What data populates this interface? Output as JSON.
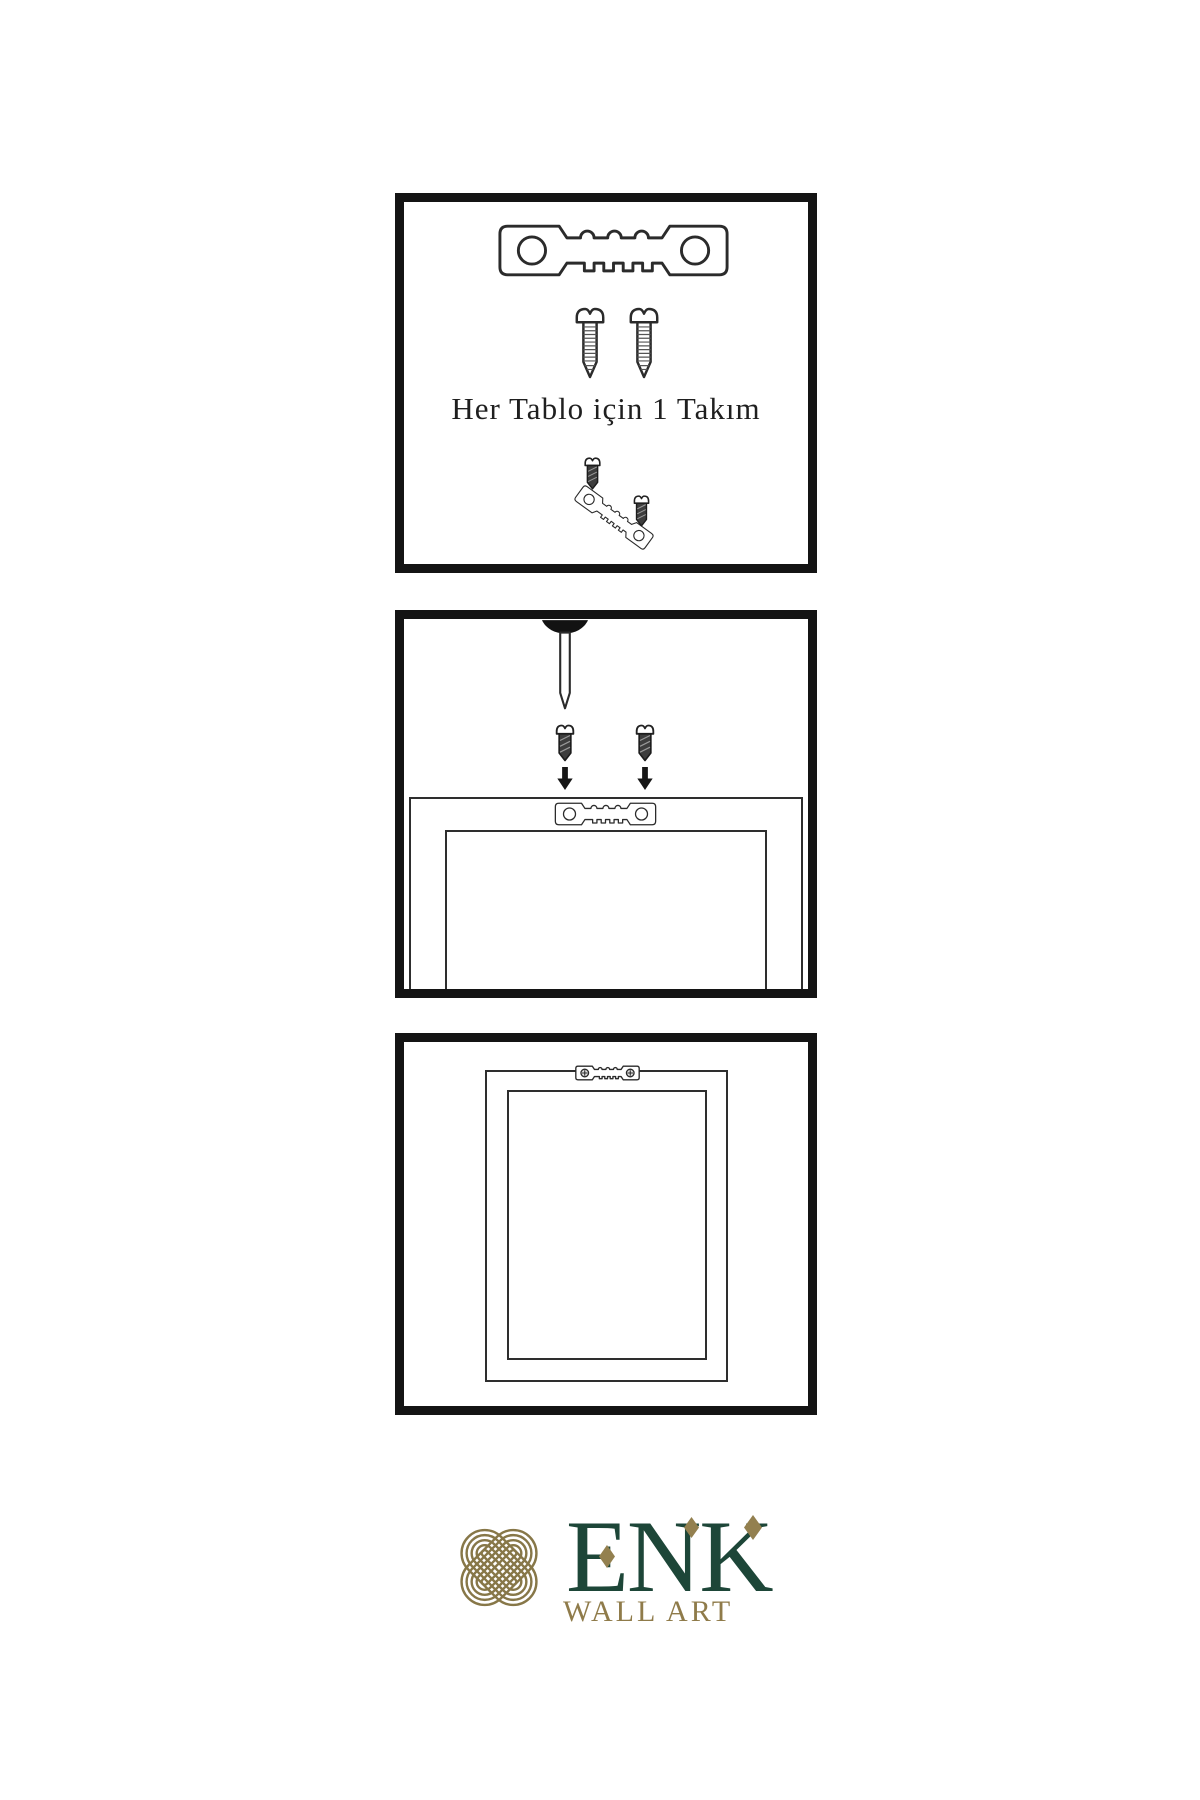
{
  "document": {
    "type": "wall-art-hanging-instructions",
    "background": "#ffffff"
  },
  "panel1": {
    "title": "hardware-kit-contents",
    "caption": "Her Tablo için 1 Takım",
    "items": [
      "sawtooth-hanger",
      "screw",
      "screw",
      "screw-driven-into-hanger-demo"
    ]
  },
  "panel2": {
    "title": "mounting-steps",
    "items": [
      "nail-in-wall",
      "screw-with-down-arrow",
      "screw-with-down-arrow",
      "frame-back-with-sawtooth-hanger"
    ]
  },
  "panel3": {
    "title": "frame-hung-on-wall",
    "items": [
      "framed-picture",
      "mounted-hanger-with-screws"
    ]
  },
  "brand": {
    "name": "ENK",
    "tagline": "WALL ART"
  },
  "colors": {
    "ink": "#141414",
    "line": "#2e2e2e",
    "brand_green": "#1d4638",
    "brand_gold": "#8f7b4a"
  }
}
